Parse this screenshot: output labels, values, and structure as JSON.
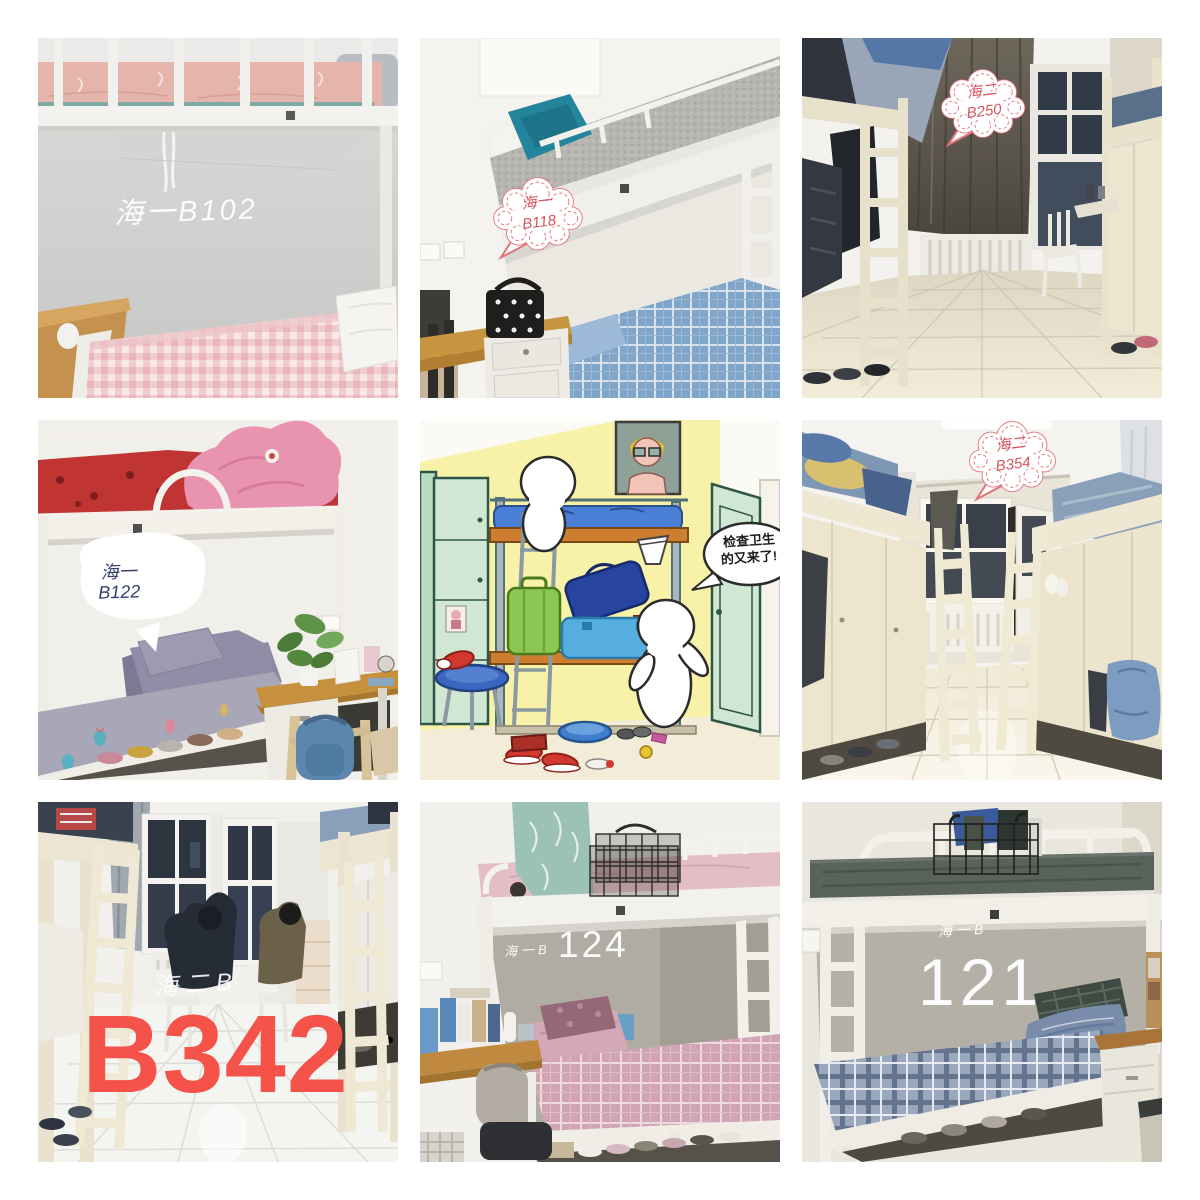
{
  "collage": {
    "background": "#ffffff",
    "rows": 3,
    "cols": 3
  },
  "colors": {
    "bubble_outline_pink": "#e4737b",
    "bubble_text_red": "#d5555e",
    "bubble_text_navy": "#333f6b",
    "label_white": "#ffffff",
    "big_number_red": "#f5524a",
    "cartoon_text": "#1d1d1d"
  },
  "tiles": {
    "b102": {
      "label": "海一B102"
    },
    "b118": {
      "line1": "海一",
      "line2": "B118"
    },
    "b250": {
      "line1": "海二",
      "line2": "B250"
    },
    "b122": {
      "line1": "海一",
      "line2": "B122"
    },
    "cartoon": {
      "bubble_line1": "检查卫生",
      "bubble_line2": "的又来了!"
    },
    "b354": {
      "line1": "海二",
      "line2": "B354"
    },
    "b342": {
      "watermark": "海二B",
      "number": "B342"
    },
    "b124": {
      "prefix": "海一B",
      "number": "124"
    },
    "b121": {
      "prefix": "海一B",
      "number": "121"
    }
  }
}
